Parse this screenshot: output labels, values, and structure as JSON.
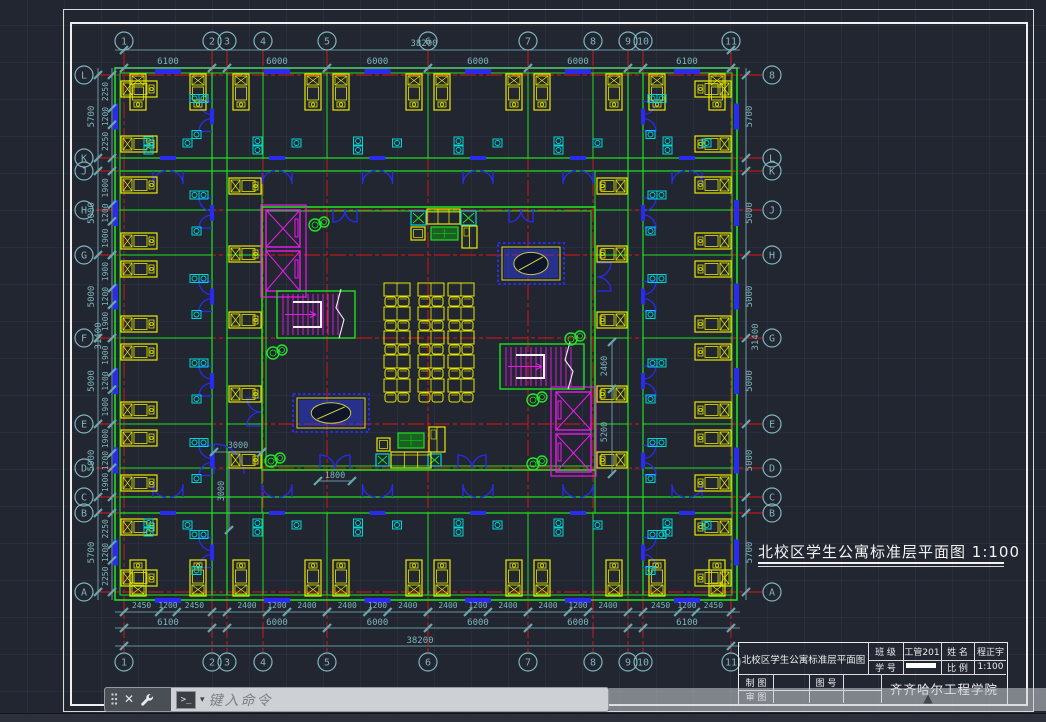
{
  "app": {
    "background": "#212631"
  },
  "command_bar": {
    "placeholder": "键入命令",
    "close_glyph": "✕",
    "prompt_glyph": ">_",
    "caret_glyph": "▾",
    "expand_glyph": "▲"
  },
  "drawing": {
    "title": "北校区学生公寓标准层平面图  1:100",
    "axis": {
      "top": [
        "1",
        "2",
        "3",
        "4",
        "5",
        "6",
        "7",
        "8",
        "9",
        "10",
        "11"
      ],
      "bottom": [
        "1",
        "2",
        "3",
        "4",
        "5",
        "6",
        "7",
        "8",
        "9",
        "10",
        "11"
      ],
      "left": [
        "L",
        "K",
        "J",
        "H",
        "G",
        "F",
        "E",
        "D",
        "C",
        "B",
        "A"
      ],
      "right": [
        "8",
        "L",
        "K",
        "J",
        "H",
        "G",
        "E",
        "D",
        "C",
        "B",
        "A"
      ]
    },
    "dims": {
      "top_bays": [
        "6100",
        "6000",
        "6000",
        "6000",
        "6000",
        "6100"
      ],
      "top_total": "38200",
      "bottom_rooms": [
        "2450",
        "1200",
        "2450",
        "2400",
        "1200",
        "2400",
        "2400",
        "1200",
        "2400",
        "2400",
        "1200",
        "2400",
        "2400",
        "1200",
        "2400",
        "2450",
        "1200",
        "2450"
      ],
      "bottom_bays": [
        "6100",
        "6000",
        "6000",
        "6000",
        "6000",
        "6100"
      ],
      "bottom_total": "38200",
      "left_rooms": [
        "2250",
        "1200",
        "2250",
        "1900",
        "1200",
        "1900",
        "1900",
        "1200",
        "1900",
        "1900",
        "1200",
        "1900",
        "1900",
        "1200",
        "1900",
        "2250",
        "1200",
        "2250"
      ],
      "left_bays": [
        "5700",
        "5000",
        "5000",
        "5000",
        "5000",
        "5700"
      ],
      "left_total": "31400",
      "right_bays": [
        "5700",
        "5000",
        "5000",
        "5000",
        "5000",
        "5700"
      ],
      "right_total": "31400",
      "interior": {
        "hall_width": "3000",
        "hall_height": "3000",
        "door": "1800",
        "stair": "2460",
        "elevator": "5200"
      }
    },
    "colors": {
      "wall": "#1fe01f",
      "grid_axis": "#e41414",
      "dimension": "#7fb6bc",
      "furniture": "#e8e800",
      "fixture": "#00d8d8",
      "door_window": "#2a2af0",
      "core": "#ea1bea",
      "plant": "#25e625",
      "rail": "#f0f0f0"
    }
  },
  "title_block": {
    "project": "北校区学生公寓标准层平面图",
    "class_label": "班 级",
    "class_value": "工管201",
    "name_label": "姓 名",
    "name_value": "程正宇",
    "student_id_label": "学 号",
    "scale_label": "比 例",
    "scale_value": "1:100",
    "draft_label": "制 图",
    "review_label": "审 图",
    "drawing_no_label": "图 号",
    "school": "齐齐哈尔工程学院"
  }
}
